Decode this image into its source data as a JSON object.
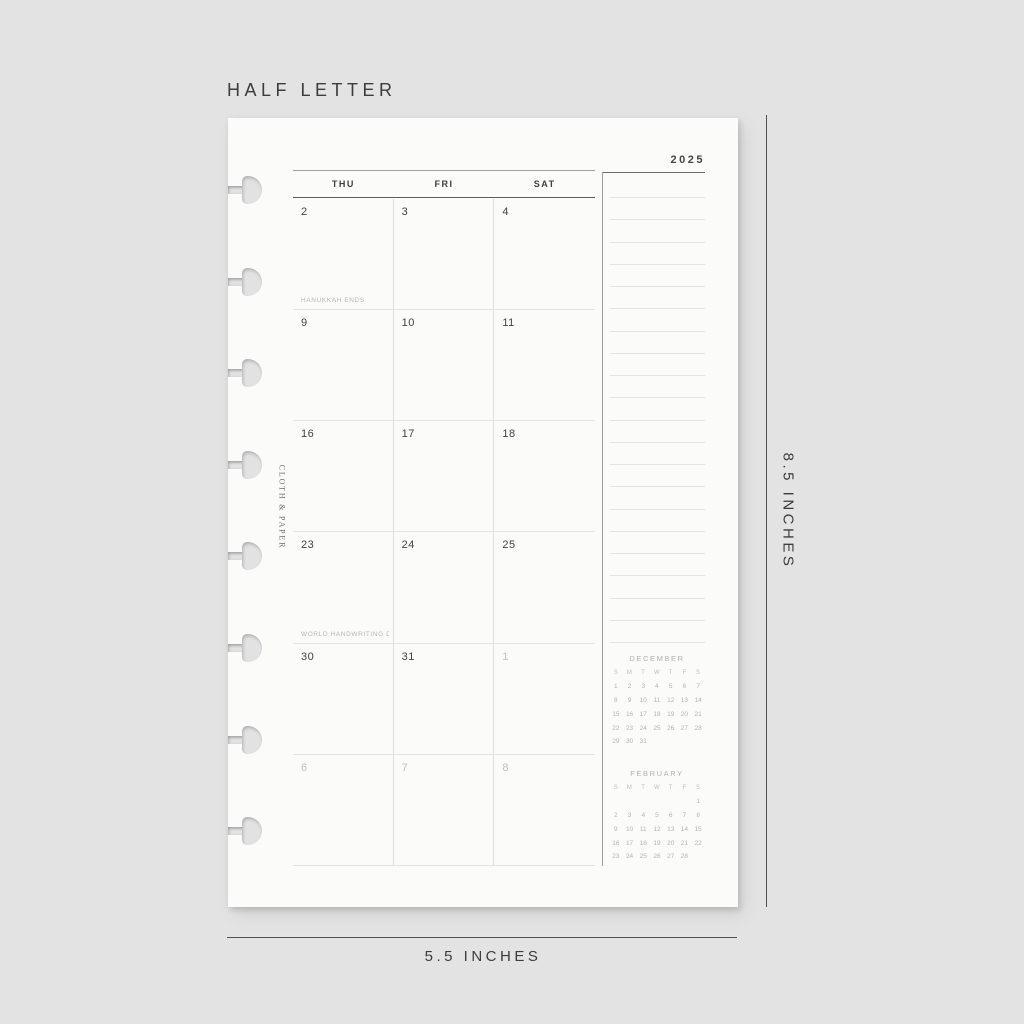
{
  "size_label": "HALF LETTER",
  "page": {
    "year": "2025",
    "brand": "CLOTH & PAPER",
    "weekday_headers": [
      "THU",
      "FRI",
      "SAT"
    ],
    "weeks": [
      {
        "days": [
          {
            "num": "2",
            "event": "HANUKKAH ENDS"
          },
          {
            "num": "3"
          },
          {
            "num": "4"
          }
        ]
      },
      {
        "days": [
          {
            "num": "9"
          },
          {
            "num": "10"
          },
          {
            "num": "11"
          }
        ]
      },
      {
        "days": [
          {
            "num": "16"
          },
          {
            "num": "17"
          },
          {
            "num": "18"
          }
        ]
      },
      {
        "days": [
          {
            "num": "23",
            "event": "WORLD HANDWRITING DAY"
          },
          {
            "num": "24"
          },
          {
            "num": "25"
          }
        ]
      },
      {
        "days": [
          {
            "num": "30"
          },
          {
            "num": "31"
          },
          {
            "num": "1",
            "muted": true
          }
        ]
      },
      {
        "days": [
          {
            "num": "6",
            "muted": true
          },
          {
            "num": "7",
            "muted": true
          },
          {
            "num": "8",
            "muted": true
          }
        ]
      }
    ],
    "notes_line_count": 21,
    "mini_calendars": [
      {
        "title": "DECEMBER",
        "day_headers": [
          "S",
          "M",
          "T",
          "W",
          "T",
          "F",
          "S"
        ],
        "weeks": [
          [
            "1",
            "2",
            "3",
            "4",
            "5",
            "6",
            "7"
          ],
          [
            "8",
            "9",
            "10",
            "11",
            "12",
            "13",
            "14"
          ],
          [
            "15",
            "16",
            "17",
            "18",
            "19",
            "20",
            "21"
          ],
          [
            "22",
            "23",
            "24",
            "25",
            "26",
            "27",
            "28"
          ],
          [
            "29",
            "30",
            "31",
            "",
            "",
            "",
            ""
          ]
        ]
      },
      {
        "title": "FEBRUARY",
        "day_headers": [
          "S",
          "M",
          "T",
          "W",
          "T",
          "F",
          "S"
        ],
        "weeks": [
          [
            "",
            "",
            "",
            "",
            "",
            "",
            "1"
          ],
          [
            "2",
            "3",
            "4",
            "5",
            "6",
            "7",
            "8"
          ],
          [
            "9",
            "10",
            "11",
            "12",
            "13",
            "14",
            "15"
          ],
          [
            "16",
            "17",
            "18",
            "19",
            "20",
            "21",
            "22"
          ],
          [
            "23",
            "24",
            "25",
            "26",
            "27",
            "28",
            ""
          ]
        ]
      }
    ]
  },
  "dimension_labels": {
    "height": "8.5 INCHES",
    "width": "5.5 INCHES"
  },
  "colors": {
    "background": "#e3e3e3",
    "page": "#fbfbfa",
    "ink": "#3f3f3f",
    "muted_text": "#bfbfbf",
    "event_text": "#b5b5b5",
    "light_line": "#e3e3e2",
    "rule": "#9c9c9c",
    "dark_rule": "#5d5d5d"
  }
}
